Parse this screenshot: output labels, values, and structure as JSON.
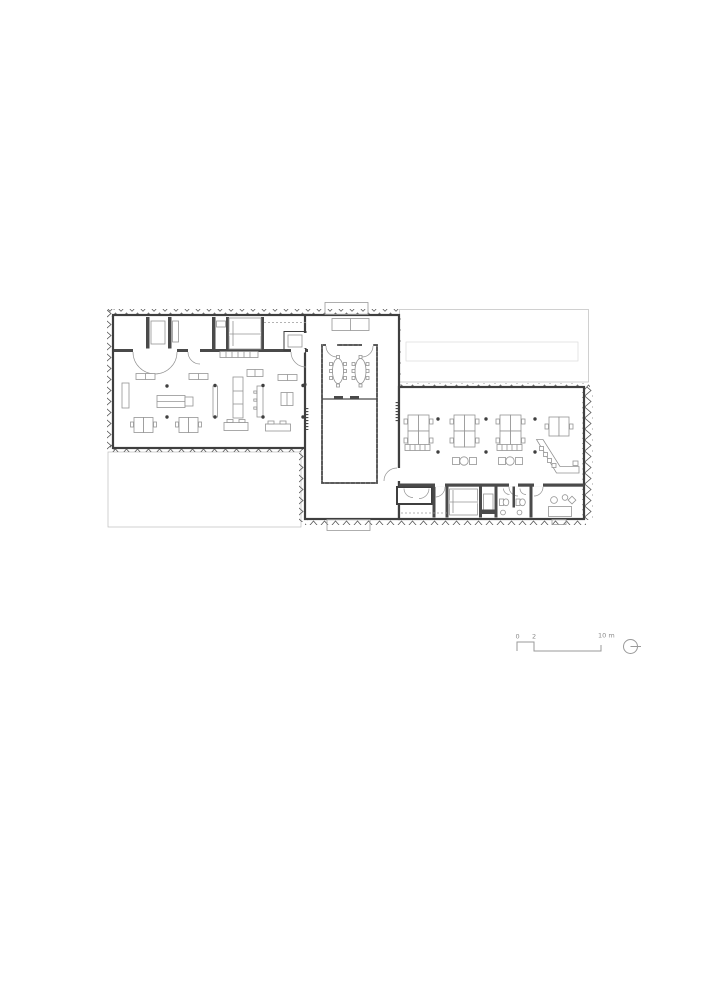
{
  "drawing": {
    "type": "architectural-floor-plan",
    "view": "ground-floor-plan"
  },
  "colors": {
    "background": "#ffffff",
    "wall": "#3f3f3f",
    "partition": "#4a4a4a",
    "furniture": "#949494",
    "hatch": "#c9c9c9",
    "hatch_border": "#bdbdbd",
    "facade": "#5a5a5a",
    "dashed": "#9a9a9a",
    "faint": "#dcdcdc",
    "scale_line": "#9a9a9a",
    "text": "#8a8a8a"
  },
  "scale_bar": {
    "label_0": "0",
    "label_2": "2",
    "label_10": "10 m"
  },
  "icons": {
    "north_symbol": "north-indicator-circle"
  }
}
